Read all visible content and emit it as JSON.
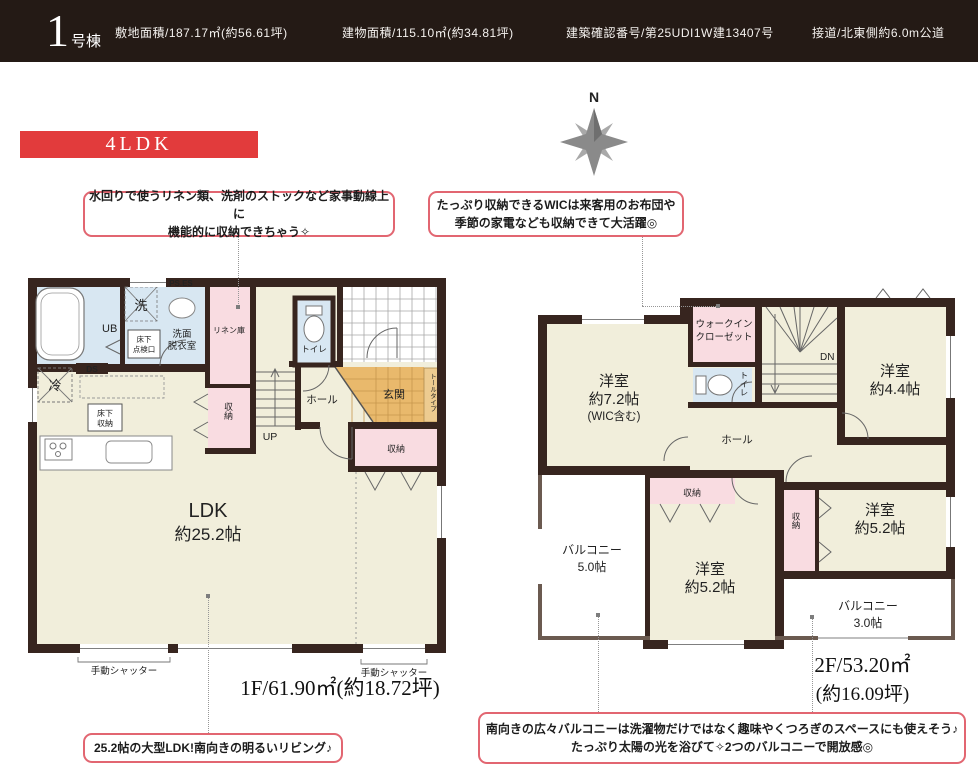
{
  "colors": {
    "header_bg": "#241a15",
    "accent_red": "#e23b3c",
    "wall": "#37251f",
    "room_cream": "#f1eedb",
    "closet_pink": "#f9dce1",
    "wet_area_blue": "#d8e7f2",
    "entry_orange": "#e9b96c",
    "callout_border": "#e26671"
  },
  "header": {
    "unit_number": "1",
    "unit_suffix": "号棟",
    "specs": [
      "敷地面積/187.17㎡(約56.61坪)",
      "建物面積/115.10㎡(約34.81坪)",
      "建築確認番号/第25UDI1W建13407号",
      "接道/北東側約6.0m公道"
    ]
  },
  "badge": {
    "label": "4LDK"
  },
  "compass": {
    "north": "N"
  },
  "callouts": {
    "linen": {
      "line1": "水回りで使うリネン類、洗剤のストックなど家事動線上に",
      "line2": "機能的に収納できちゃう✧"
    },
    "wic": {
      "line1": "たっぷり収納できるWICは来客用のお布団や",
      "line2": "季節の家電なども収納できて大活躍◎"
    },
    "ldk": {
      "line1": "25.2帖の大型LDK!南向きの明るいリビング♪"
    },
    "balcony": {
      "line1": "南向きの広々バルコニーは洗濯物だけではなく趣味やくつろぎのスペースにも使えそう♪",
      "line2": "たっぷり太陽の光を浴びて✧2つのバルコニーで開放感◎"
    }
  },
  "floor1": {
    "title": "1F/61.90㎡(約18.72坪)",
    "labels": {
      "ub": "UB",
      "wash": "洗",
      "ps_es": "PS.ES",
      "senmen_1": "洗面",
      "senmen_2": "脱衣室",
      "tenken_1": "床下",
      "tenken_2": "点検口",
      "linen": "リネン庫",
      "toilet": "トイレ",
      "genkan": "玄関",
      "tall_type": "トールタイプ",
      "hall": "ホール",
      "up": "UP",
      "ds": "DS",
      "fridge": "冷",
      "yukashita_1": "床下",
      "yukashita_2": "収納",
      "closet_mid": "収納",
      "closet_right": "収納",
      "ldk_1": "LDK",
      "ldk_2": "約25.2帖",
      "shutter_left": "手動シャッター",
      "shutter_right": "手動シャッター"
    }
  },
  "floor2": {
    "title_1": "2F/53.20㎡",
    "title_2": "(約16.09坪)",
    "labels": {
      "room72_1": "洋室",
      "room72_2": "約7.2帖",
      "room72_3": "(WIC含む)",
      "wic_1": "ウォークイン",
      "wic_2": "クローゼット",
      "toilet": "トイレ",
      "dn": "DN",
      "room44_1": "洋室",
      "room44_2": "約4.4帖",
      "hall": "ホール",
      "balc5_1": "バルコニー",
      "balc5_2": "5.0帖",
      "closet_c": "収納",
      "room52c_1": "洋室",
      "room52c_2": "約5.2帖",
      "closet_r": "収納",
      "room52r_1": "洋室",
      "room52r_2": "約5.2帖",
      "balc3_1": "バルコニー",
      "balc3_2": "3.0帖"
    }
  }
}
